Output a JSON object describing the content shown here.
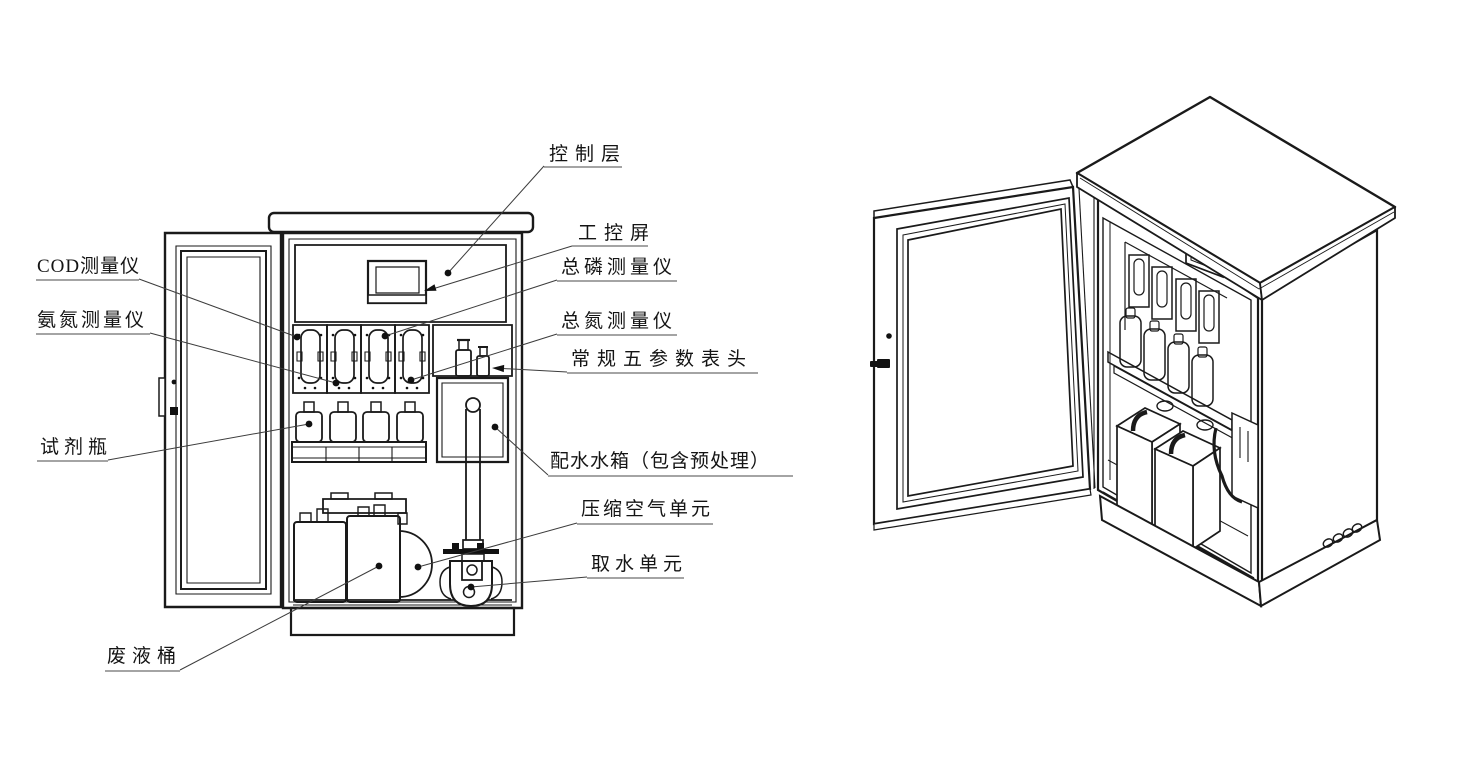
{
  "diagram": {
    "description_labels": true,
    "colors": {
      "line": "#1a1a1a",
      "underline": "#6e6e6e",
      "background": "#ffffff",
      "marker": "#111111"
    }
  },
  "labels": [
    {
      "id": "control-layer",
      "text": "控制层"
    },
    {
      "id": "industrial-screen",
      "text": "工控屏"
    },
    {
      "id": "tp-analyzer",
      "text": "总磷测量仪"
    },
    {
      "id": "tn-analyzer",
      "text": "总氮测量仪"
    },
    {
      "id": "five-param-meter",
      "text": "常规五参数表头"
    },
    {
      "id": "water-tank",
      "text": "配水水箱（包含预处理）"
    },
    {
      "id": "air-unit",
      "text": "压缩空气单元"
    },
    {
      "id": "water-intake",
      "text": "取水单元"
    },
    {
      "id": "cod-analyzer",
      "text": "COD测量仪"
    },
    {
      "id": "nh3n-analyzer",
      "text": "氨氮测量仪"
    },
    {
      "id": "reagent-bottle",
      "text": "试剂瓶"
    },
    {
      "id": "waste-barrel",
      "text": "废液桶"
    }
  ]
}
